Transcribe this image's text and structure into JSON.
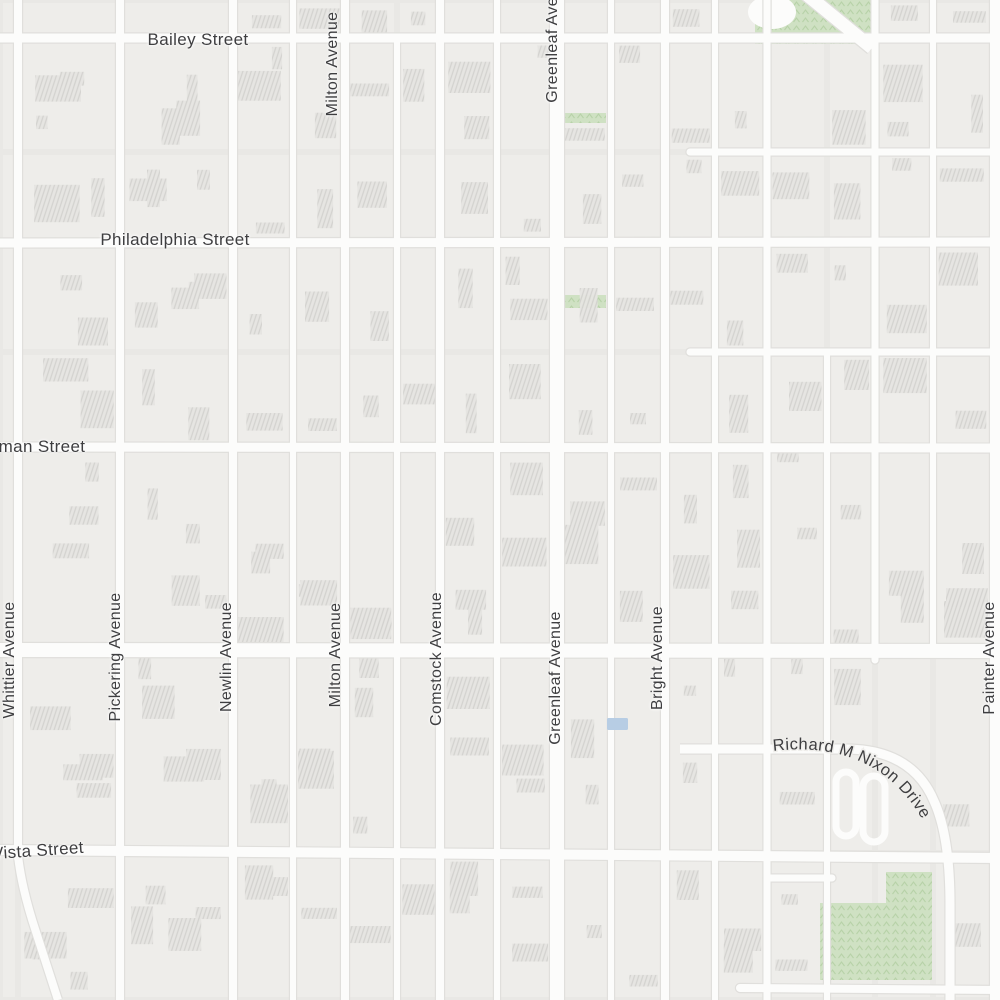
{
  "map": {
    "kind": "street-map-tile",
    "street_labels": {
      "horizontal": [
        {
          "name": "bailey-street",
          "text": "Bailey Street",
          "x": 198,
          "y": 40,
          "size": 17,
          "angle": 0
        },
        {
          "name": "philadelphia-street",
          "text": "Philadelphia Street",
          "x": 175,
          "y": 240,
          "size": 17,
          "angle": 0
        },
        {
          "name": "wardman-street-partial",
          "text": "man Street",
          "x": 42,
          "y": 447,
          "size": 17,
          "angle": 0
        },
        {
          "name": "vista-street-partial",
          "text": "Vista Street",
          "x": 38,
          "y": 851,
          "size": 17,
          "angle": -4
        }
      ],
      "vertical": [
        {
          "name": "milton-avenue-north",
          "text": "Milton Avenue",
          "x": 333,
          "y": 64,
          "size": 16
        },
        {
          "name": "greenleaf-avenue-north",
          "text": "Greenleaf Avenue",
          "x": 553,
          "y": 36,
          "size": 16
        },
        {
          "name": "whittier-avenue",
          "text": "Whittier Avenue",
          "x": 10,
          "y": 660,
          "size": 16
        },
        {
          "name": "pickering-avenue",
          "text": "Pickering Avenue",
          "x": 116,
          "y": 657,
          "size": 16
        },
        {
          "name": "newlin-avenue",
          "text": "Newlin Avenue",
          "x": 227,
          "y": 657,
          "size": 16
        },
        {
          "name": "milton-avenue",
          "text": "Milton Avenue",
          "x": 336,
          "y": 655,
          "size": 16
        },
        {
          "name": "comstock-avenue",
          "text": "Comstock Avenue",
          "x": 437,
          "y": 659,
          "size": 16
        },
        {
          "name": "greenleaf-avenue",
          "text": "Greenleaf Avenue",
          "x": 556,
          "y": 678,
          "size": 16
        },
        {
          "name": "bright-avenue",
          "text": "Bright Avenue",
          "x": 658,
          "y": 658,
          "size": 16
        },
        {
          "name": "painter-avenue",
          "text": "Painter Avenue",
          "x": 990,
          "y": 658,
          "size": 16
        }
      ],
      "curved": [
        {
          "name": "richard-m-nixon-drive",
          "text": "Richard M Nixon Drive",
          "size": 16.5
        }
      ]
    },
    "colors": {
      "background": "#e9e8e5",
      "block": "#efeeeb",
      "block_alt": "#edecd9",
      "road": "#fcfcfb",
      "road_casing": "#e0dfdc",
      "building": "#e6e5e2",
      "building_hatch": "#d2d1ce",
      "park": "#cfe1c3",
      "park_pattern": "#b7d2a8",
      "pool": "#b7cde4",
      "label": "#3e3e40"
    }
  }
}
